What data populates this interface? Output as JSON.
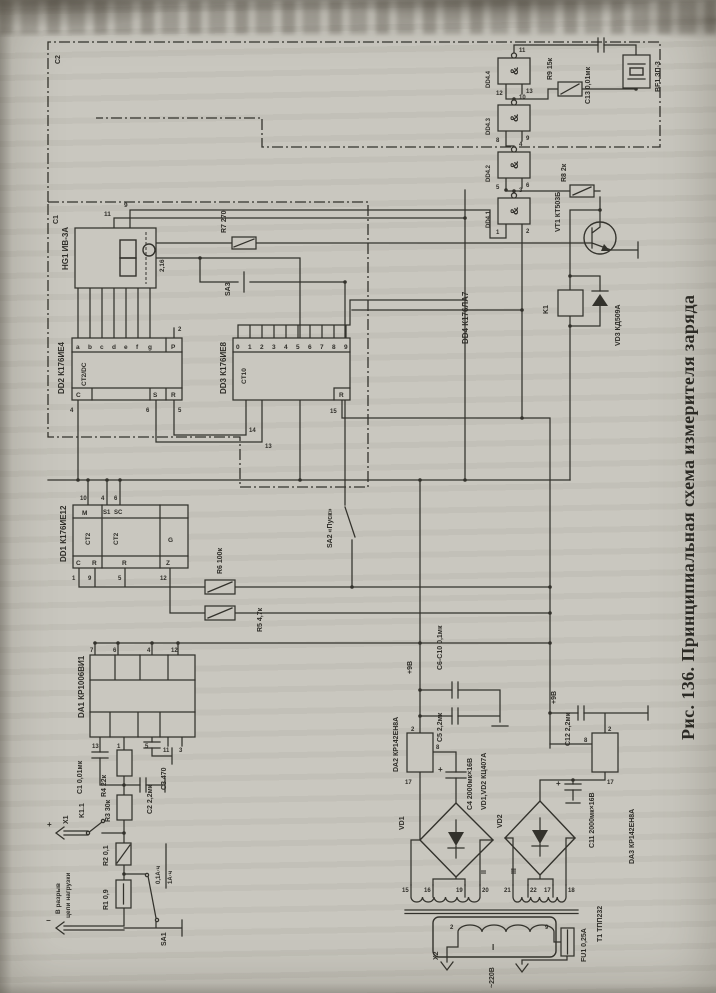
{
  "page": {
    "caption": "Рис. 136. Принципиальная схема измерителя заряда",
    "paper": "#c9c7bf",
    "ink": "#33322c"
  },
  "frames": {
    "outer": "C2",
    "inner": "C1"
  },
  "hg1": {
    "name": "HG1 ИВ-3А",
    "pin11": "11",
    "pin9": "9",
    "pin216": "2,16"
  },
  "dd2": {
    "name": "DD2 К176ИЕ4",
    "func": "CT2/DC",
    "p": "P",
    "pin_p": "2",
    "c": "C",
    "s": "S",
    "r": "R",
    "pin_c": "4",
    "pin_s": "6",
    "pin_r": "5",
    "outs": [
      "a",
      "b",
      "c",
      "d",
      "e",
      "f",
      "g"
    ]
  },
  "dd3": {
    "name": "DD3 К176ИЕ8",
    "func": "CT10",
    "r": "R",
    "pin_r": "15",
    "pin14": "14",
    "pin13": "13",
    "outs": [
      "0",
      "1",
      "2",
      "3",
      "4",
      "5",
      "6",
      "7",
      "8",
      "9"
    ]
  },
  "dd1": {
    "name": "DD1 К176ИЕ12",
    "ct_a": "CT2",
    "ct_b": "CT2",
    "m": "M",
    "s1": "S1",
    "sc": "SC",
    "g": "G",
    "c": "C",
    "r_a": "R",
    "r_b": "R",
    "z": "Z",
    "pin_m": "10",
    "pin_s1": "4",
    "pin_sc": "6",
    "pin_c": "1",
    "pin_ra": "9",
    "pin_rb": "5",
    "pin_z": "12"
  },
  "dd4": {
    "name": "DD4 К176ЛА7",
    "amp": "&",
    "gates": [
      {
        "label": "DD4.1",
        "out": "3",
        "in1": "1",
        "in2": "2"
      },
      {
        "label": "DD4.2",
        "out": "4",
        "in1": "5",
        "in2": "6"
      },
      {
        "label": "DD4.3",
        "out": "10",
        "in1": "8",
        "in2": "9"
      },
      {
        "label": "DD4.4",
        "out": "11",
        "in1": "12",
        "in2": "13"
      }
    ]
  },
  "parts": {
    "r7": "R7 270",
    "sa3": "SA3",
    "sa2": "SA2 «Пуск»",
    "r6": "R6 100к",
    "r5": "R5 4,7к",
    "r9": "R9 15к",
    "c13": "C13 0,01мк",
    "bf1": "BF1 ЗП-3",
    "r8": "R8 2к",
    "vt1": "VT1 КТ503Б",
    "k1": "K1",
    "vd3": "VD3 КД509А",
    "da1": "DA1 КР1006ВИ1",
    "c1": "C1 0,01мк",
    "r4": "R4 22к",
    "c3": "C3 470",
    "c2": "C2 2,2мк",
    "r3": "R3 30к",
    "k11": "K1.1",
    "x1": "X1",
    "plus": "+",
    "minus": "−",
    "note1": "В разрыв",
    "note2": "цепи нагрузки",
    "r2": "R2 0,1",
    "r1": "R1 0,9",
    "sa1": "SA1",
    "ah1": "0,1А·ч",
    "ah2": "1А·ч",
    "p9a": "+9В",
    "p9b": "+9В",
    "c6c10": "C6-C10 0,1мк",
    "c5": "C5 2,2мк",
    "vd12": "VD1,VD2 КЦ407А",
    "da2": "DA2 КР142ЕН8А",
    "c4": "C4 2000мк×16В",
    "vd1": "VD1",
    "vd2": "VD2",
    "w1": "I",
    "w2": "II",
    "w3": "III",
    "t1": "Т1 ТПП232",
    "x2": "X2",
    "v220": "~220В",
    "fu1": "FU1 0,25А",
    "da3": "DA3 КР142ЕН8А",
    "c11": "C11 2000мк×16В",
    "c12": "C12 2,2мк"
  },
  "da1_pins": {
    "top": [
      "7",
      "6",
      "4",
      "12"
    ],
    "bottom": [
      "13",
      "1",
      "5",
      "11",
      "3"
    ]
  },
  "da2_pins": {
    "p2": "2",
    "p8": "8",
    "p17": "17"
  },
  "da3_pins": {
    "p2": "2",
    "p8": "8",
    "p17": "17"
  },
  "t1_pins": {
    "sec": [
      "15",
      "16",
      "19",
      "20",
      "21",
      "22",
      "17",
      "18"
    ],
    "pri": [
      "2",
      "9"
    ]
  }
}
